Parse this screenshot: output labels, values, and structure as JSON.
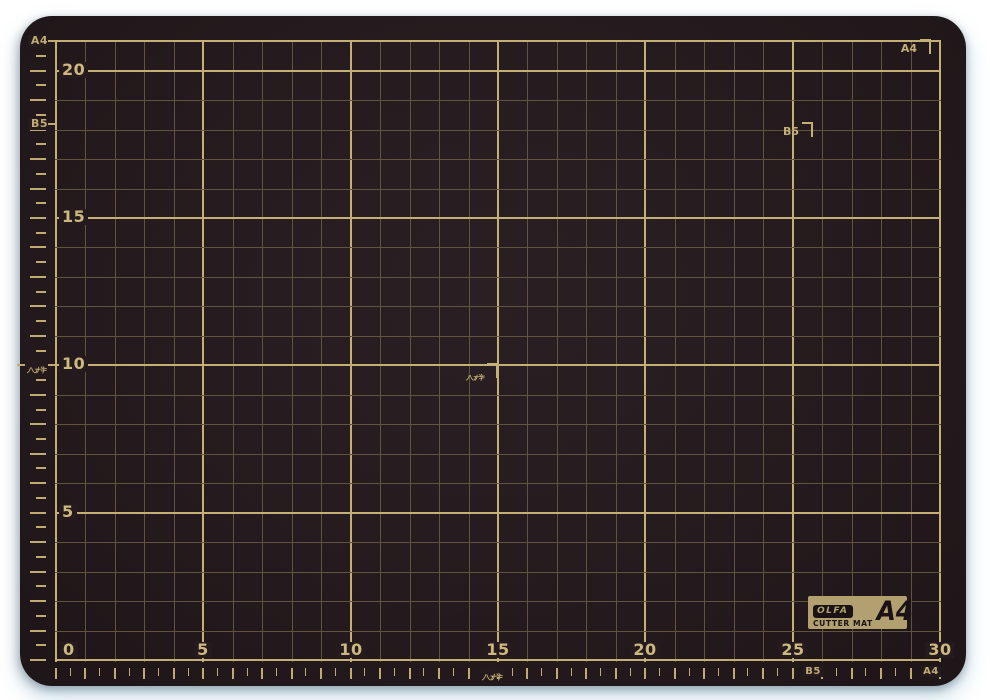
{
  "colors": {
    "background": "#ffffff",
    "mat": "#251b1e",
    "mat_highlight": "#2a1f23",
    "mat_shadow": "#1e1518",
    "grid_minor": "#61543e",
    "grid_major": "#c4af75",
    "number_text": "#cdb87e",
    "margin_text": "#c0ab72",
    "badge_tan": "#b2a070",
    "badge_black": "#1a1215"
  },
  "grid": {
    "x_min": 0,
    "x_max": 30,
    "y_min": 0,
    "y_max": 21,
    "minor_step": 1,
    "major_step": 5,
    "tick_step": 0.5,
    "x_axis_numbers": [
      {
        "v": 0,
        "t": "0"
      },
      {
        "v": 5,
        "t": "5"
      },
      {
        "v": 10,
        "t": "10"
      },
      {
        "v": 15,
        "t": "15"
      },
      {
        "v": 20,
        "t": "20"
      },
      {
        "v": 25,
        "t": "25"
      },
      {
        "v": 30,
        "t": "30"
      }
    ],
    "y_axis_numbers": [
      {
        "v": 5,
        "t": "5"
      },
      {
        "v": 10,
        "t": "10"
      },
      {
        "v": 15,
        "t": "15"
      },
      {
        "v": 20,
        "t": "20"
      }
    ]
  },
  "left_margin_labels": [
    {
      "text": "A4",
      "v": 21,
      "type": "text"
    },
    {
      "text": "B5",
      "v": 18.2,
      "type": "text"
    },
    {
      "text": "ハガキ",
      "v": 10,
      "type": "hagaki"
    }
  ],
  "bottom_margin_labels": [
    {
      "text": "ハガキ",
      "v": 14.8,
      "type": "hagaki"
    },
    {
      "text": "B5",
      "v": 25.7,
      "type": "text"
    },
    {
      "text": "A4",
      "v": 29.7,
      "type": "text"
    }
  ],
  "paper_corner_markers": [
    {
      "text": "A4",
      "x": 29.7,
      "y": 21,
      "type": "text"
    },
    {
      "text": "B5",
      "x": 25.7,
      "y": 18.2,
      "type": "text"
    },
    {
      "text": "ハガキ",
      "x": 15,
      "y": 10,
      "type": "hagaki"
    }
  ],
  "badge": {
    "brand": "OLFA",
    "product": "CUTTER MAT",
    "size": "A4"
  }
}
